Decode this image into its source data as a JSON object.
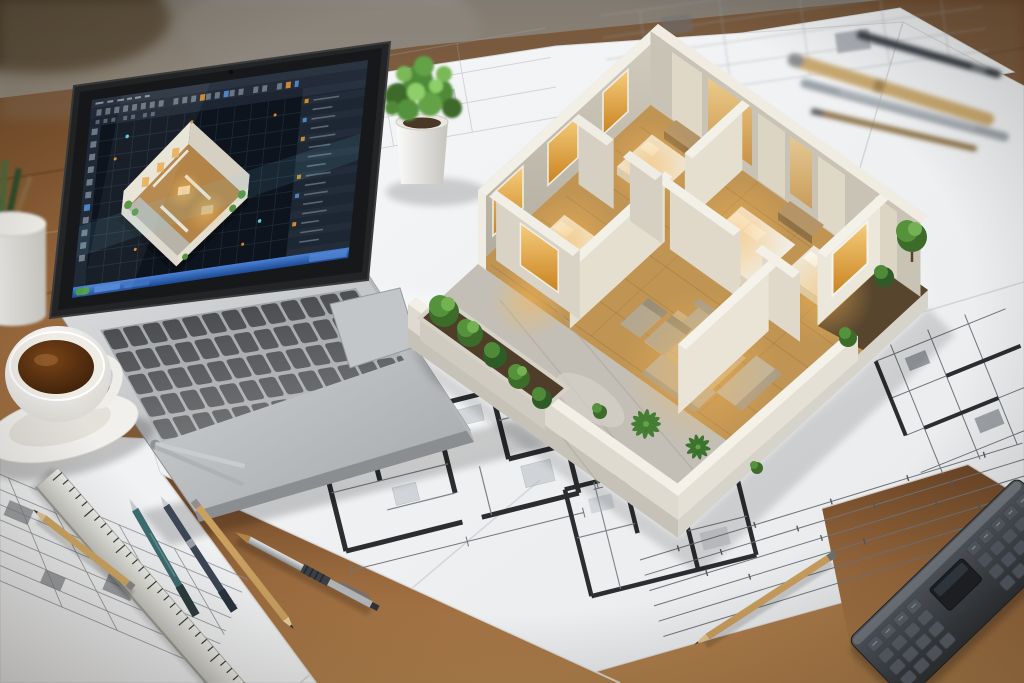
{
  "scene": {
    "setting": "architect workspace desk viewed from a high oblique angle",
    "style": "photorealistic render, shallow depth of field, warm daylight",
    "no_legible_text": true
  },
  "laptop": {
    "label": "silver laptop running 3D floor-plan CAD software",
    "screen": {
      "theme": "dark",
      "menu_bar": "unlabeled dark menu strip",
      "icon_toolbar": "rows of small tool icons, a few amber and blue",
      "left_palette": "vertical tool icon column",
      "right_panel": "properties and layer rows with amber and blue highlight chips",
      "viewport": "dark 3D viewport with modeling grid",
      "viewport_content": "isometric cutaway apartment model with warm interior lighting and greenery",
      "taskbar": "blue gradient taskbar with app segments",
      "accent_colors": {
        "amber": "#cf8b2e",
        "blue": "#4f84c4",
        "taskbar_blue": "#2d62b2"
      }
    },
    "keyboard": "dark keys on aluminum deck",
    "trackpad": "large rounded trackpad",
    "body_color": "#c9ccce"
  },
  "physical_model": {
    "label": "physical 3D cutaway apartment model standing on blueprints",
    "rooms": [
      "bedroom back-left",
      "bedroom back-center",
      "bedroom left",
      "bedroom right",
      "living room with sofa set and coffee table",
      "front stone terrace",
      "right balcony planter"
    ],
    "furniture": [
      "double beds with white duvets and pillows",
      "beige sofa group around dark coffee table",
      "pair of lounge chairs",
      "wardrobe and counter blocks"
    ],
    "landscaping": [
      "green trees in left planter box",
      "palm plants on terrace",
      "trees on right balcony"
    ],
    "lighting": "warm amber glow from windows and interiors",
    "colors": {
      "walls_lit": "#e9e4d6",
      "walls_shade": "#c9c3b6",
      "wall_tops": "#f3f0e8",
      "wood_floor": "#b98a4e",
      "terrace_stone": "#c3bfb6",
      "foliage": "#4f8a38",
      "window_glow": "#e8b25c"
    }
  },
  "blueprints": {
    "label": "white architectural blueprint sheets covering the desk",
    "content": "floor plans with thick wall outlines, furniture hatching, dimension lines and tick marks; annotations too small to read",
    "paper_color": "#f3f4f5",
    "line_color": "#6f747b",
    "wall_color": "#2b2d30"
  },
  "desk_objects": [
    {
      "id": "potted-plant",
      "label": "small green plant in white cylindrical pot"
    },
    {
      "id": "coffee-cup",
      "label": "white cup of coffee on saucer"
    },
    {
      "id": "pencil-cup",
      "label": "white holder with pencils, blurred, left edge"
    },
    {
      "id": "metal-ruler",
      "label": "metal ruler with tick marks"
    },
    {
      "id": "divider-compass",
      "label": "metal divider compass"
    },
    {
      "id": "pencil-tan",
      "label": "sharpened tan wooden pencil"
    },
    {
      "id": "pencil-teal",
      "label": "teal mechanical pencil"
    },
    {
      "id": "pencil-navy",
      "label": "dark navy mechanical pencil"
    },
    {
      "id": "pencil-wood",
      "label": "natural wood pencil"
    },
    {
      "id": "drafting-pen",
      "label": "brass and steel drafting pen"
    },
    {
      "id": "pencil-bottom",
      "label": "wooden pencil lying on blueprint, bottom right"
    },
    {
      "id": "calculator",
      "label": "dark gray calculator / digital scale ruler"
    },
    {
      "id": "pens-top-right",
      "label": "blurred drafting pens and pencils, top right"
    }
  ],
  "materials": {
    "desk_wood": "#8a5a33",
    "background_wall": "#8e8a85"
  }
}
